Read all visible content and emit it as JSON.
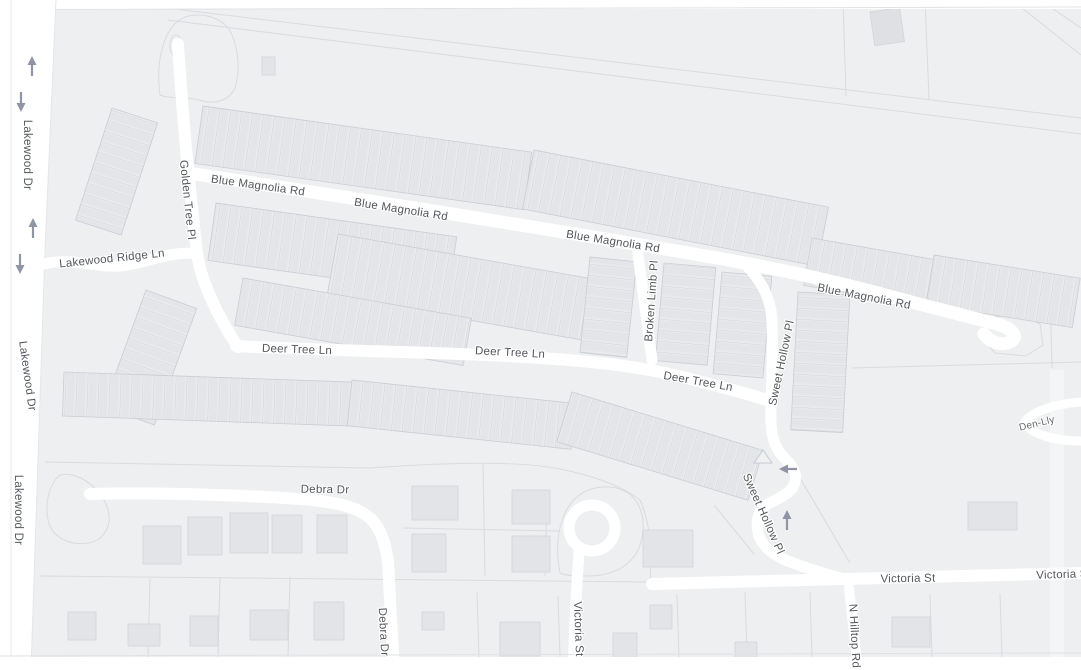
{
  "map": {
    "type": "street-map",
    "labels": {
      "lakewood_dr": "Lakewood Dr",
      "golden_tree_pl": "Golden Tree Pl",
      "blue_magnolia_rd": "Blue Magnolia Rd",
      "lakewood_ridge_ln": "Lakewood Ridge Ln",
      "deer_tree_ln": "Deer Tree Ln",
      "broken_limb_pl": "Broken Limb Pl",
      "sweet_hollow_pl": "Sweet Hollow Pl",
      "debra_dr": "Debra Dr",
      "victoria_st": "Victoria St",
      "victoria_st_cut": "Victoria S",
      "n_hilltop_rd": "N Hilltop Rd",
      "partial_label_right_edge": "Den-Lly"
    },
    "colors": {
      "background": "#edeff1",
      "road": "#ffffff",
      "building": "#e5e6e9",
      "rowhouse_strip": "#e8e9ec",
      "parcel_line": "#d9dbde",
      "label_text": "#54575d",
      "one_way_arrow": "#8f95a4"
    },
    "icons": [
      "one-way-up-arrow",
      "one-way-down-arrow",
      "one-way-left-arrow",
      "traffic-island-triangle"
    ]
  }
}
